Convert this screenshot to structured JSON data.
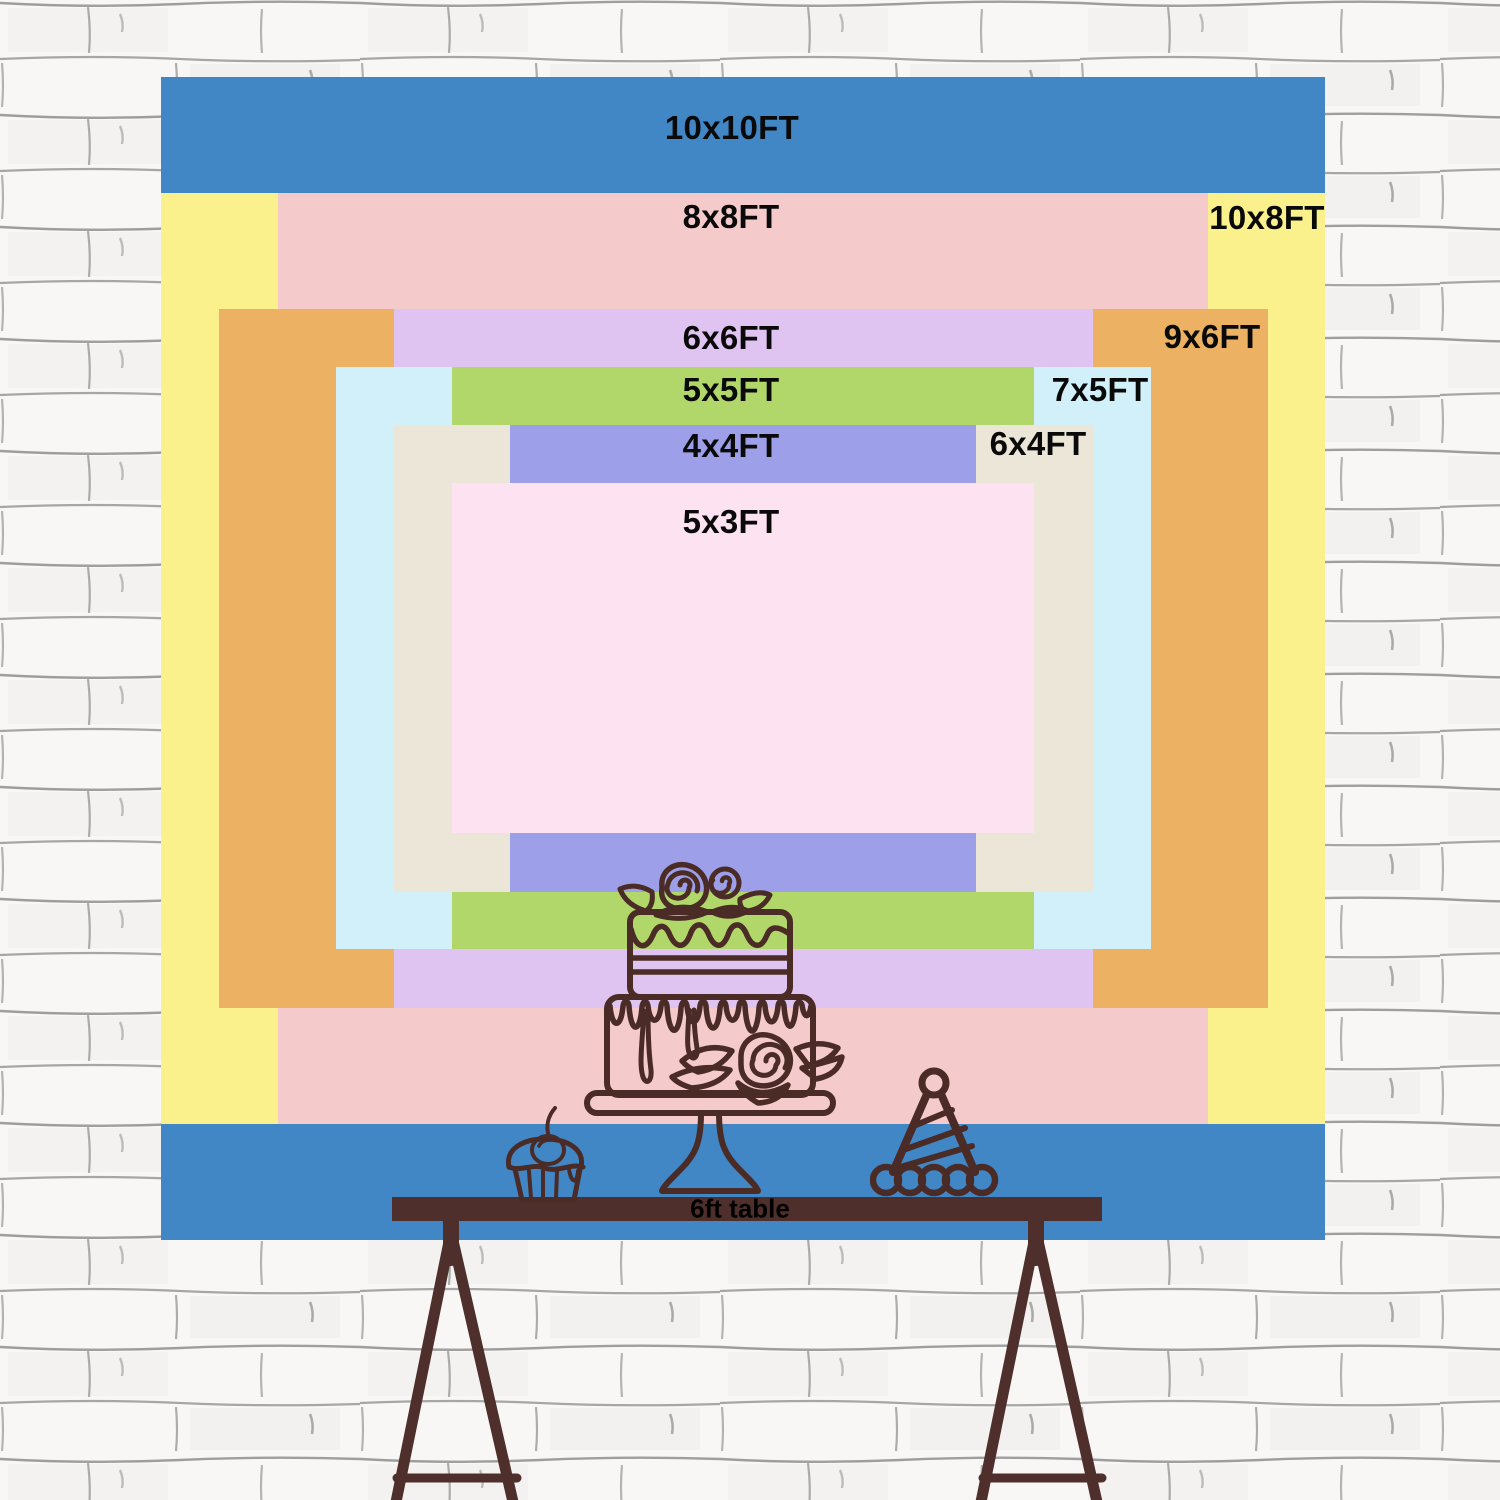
{
  "title": "Backdrop size comparison chart",
  "sizes": [
    {
      "label": "10x10FT",
      "color": "#4186c5"
    },
    {
      "label": "10x8FT",
      "color": "#faf18c"
    },
    {
      "label": "8x8FT",
      "color": "#f5caca"
    },
    {
      "label": "9x6FT",
      "color": "#ecb162"
    },
    {
      "label": "6x6FT",
      "color": "#dfc4f1"
    },
    {
      "label": "7x5FT",
      "color": "#d2f0f9"
    },
    {
      "label": "5x5FT",
      "color": "#b1d76a"
    },
    {
      "label": "6x4FT",
      "color": "#ebe6d7"
    },
    {
      "label": "4x4FT",
      "color": "#9da0e8"
    },
    {
      "label": "5x3FT",
      "color": "#fde2f2"
    }
  ],
  "table": {
    "label": "6ft table"
  },
  "illustration": {
    "items": [
      "tiered-cake",
      "cupcake",
      "party-hat"
    ]
  },
  "theme": {
    "line": "#4a2b26",
    "table": "#4e2f2b",
    "wall": "#f8f7f5",
    "mortar": "#6f6f6f",
    "text": "#0a0a0a"
  }
}
